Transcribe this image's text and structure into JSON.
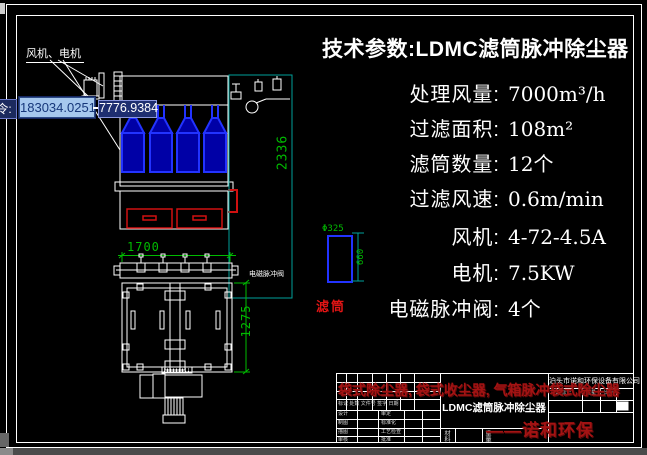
{
  "tech_params": {
    "title": "技术参数:LDMC滤筒脉冲除尘器",
    "rows": [
      {
        "label": "处理风量:",
        "value": "7000m³/h"
      },
      {
        "label": "过滤面积:",
        "value": "108m²"
      },
      {
        "label": "滤筒数量:",
        "value": "12个"
      },
      {
        "label": "过滤风速:",
        "value": "0.6m/min"
      },
      {
        "label": "风机:",
        "value": "4-72-4.5A"
      },
      {
        "label": "电机:",
        "value": "7.5KW"
      },
      {
        "label": "电磁脉冲阀:",
        "value": "4个"
      }
    ]
  },
  "drawing": {
    "fan_motor_label": "风机、电机",
    "pulse_valve_label": "电磁脉冲阀",
    "filter_cartridge_label": "滤筒",
    "dim_height": "2336",
    "dim_width": "1700",
    "dim_depth": "1275",
    "dim_cartridge_dia": "Φ325",
    "dim_cartridge_len": "660"
  },
  "dynamic_input": {
    "prompt": "令:",
    "x_value": "183034.0251",
    "y_value": "7776.9384"
  },
  "title_block": {
    "company": "泊头市诺和环保设备有限公司",
    "drawing_title": "LDMC滤筒脉冲除尘器",
    "watermark_line1": "袋式除尘器, 袋式收尘器, 气箱脉冲袋式除尘器",
    "watermark_line2": "——诺和环保",
    "rev_header": "标记 处数 文件号 签字 日期",
    "sig_rows": [
      {
        "left": "设计",
        "mid": "审定"
      },
      {
        "left": "制图",
        "mid": "标准化"
      },
      {
        "left": "描图",
        "mid": "工艺检查"
      },
      {
        "left": "审核",
        "mid": "批准"
      }
    ],
    "stage_label": "阶段标记",
    "weight_label": "重量",
    "scale_label": "比例",
    "material_label": "材料",
    "mass_label": "重量"
  },
  "colors": {
    "line_white": "#ffffff",
    "cad_blue": "#2233ff",
    "cad_blue_fill": "#0000a6",
    "cad_red": "#d01010",
    "dim_green": "#00bb00",
    "dim_teal": "#00a09a",
    "watermark_red": "#a31313",
    "input_active_bg": "#a6c8ee",
    "input_bg": "#1e2e70"
  }
}
